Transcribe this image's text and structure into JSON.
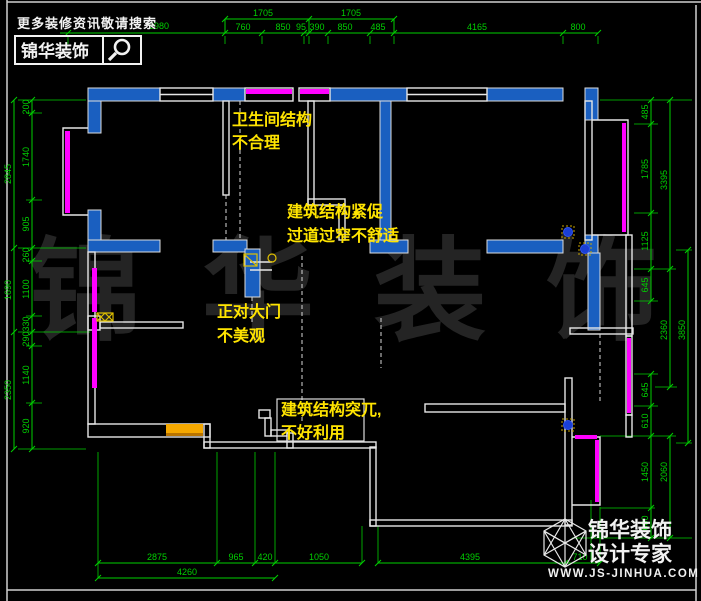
{
  "search_banner": {
    "tagline": "更多装修资讯敬请搜索",
    "brand": "锦华装饰"
  },
  "watermark": {
    "chars": [
      "锦",
      "华",
      "装",
      "饰"
    ]
  },
  "annotations": [
    {
      "line1": "卫生间结构",
      "line2": "不合理"
    },
    {
      "line1": "建筑结构紧促",
      "line2": "过道过窄不舒适"
    },
    {
      "line1": "正对大门",
      "line2": "不美观"
    },
    {
      "line1": "建筑结构突兀,",
      "line2": "不好利用"
    }
  ],
  "dimensions": {
    "top_row1": [
      "1705",
      "1705"
    ],
    "top_row2": [
      "2980",
      "760",
      "850",
      "95",
      "390",
      "850",
      "485",
      "4165",
      "800"
    ],
    "left_outer": [
      "2845",
      "1690",
      "2350"
    ],
    "left_inner": [
      "200",
      "1740",
      "905",
      "260",
      "1100",
      "330",
      "290",
      "1140",
      "920"
    ],
    "right_inner": [
      "485",
      "1785",
      "1125",
      "645",
      "645",
      "610",
      "1450",
      "600"
    ],
    "right_outer": [
      "3395",
      "2360",
      "2060"
    ],
    "right_outermost": [
      "3850"
    ],
    "bottom_row1": [
      "2875",
      "965",
      "420",
      "1050",
      "4395",
      "710"
    ],
    "bottom_row2": [
      "4260"
    ]
  },
  "footer_logo": {
    "brand": "锦华装饰",
    "tagline": "设计专家",
    "website": "WWW.JS-JINHUA.COM"
  },
  "colors": {
    "dimension_green": "#00cf00",
    "wall_blue": "#1a5fc0",
    "window_magenta": "#ff00ff",
    "annotation_yellow": "#ffe400",
    "cabinet_orange": "#f5a800",
    "wall_white": "#e6e6e6"
  }
}
